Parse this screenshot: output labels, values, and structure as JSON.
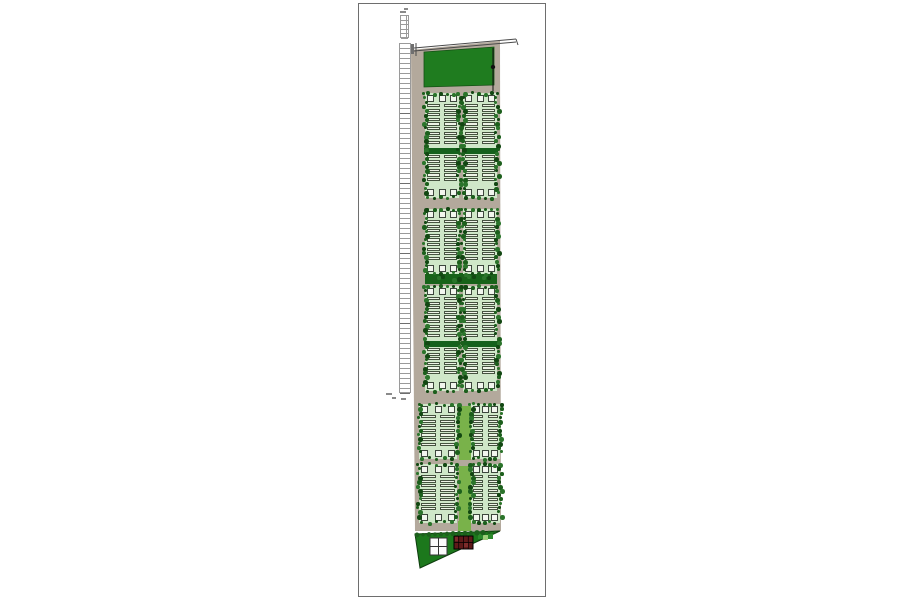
{
  "window": {
    "background": "#ffffff"
  },
  "page": {
    "x": 358,
    "y": 3,
    "width": 188,
    "height": 594,
    "background": "#ffffff",
    "border_color": "#6e6e6e"
  },
  "palette": {
    "road_tan": "#b3a99c",
    "park_green": "#1f7c1f",
    "park_edge": "#155015",
    "block_green": "#cfe7c8",
    "unit_fill": "#eef4e7",
    "unit_border": "#45523f",
    "cap_fill": "#f2f6ee",
    "cap_border": "#3c463c",
    "mid_band_green": "#15611c",
    "sep_band_green": "#176319",
    "accent_green": "#79b24a",
    "tree_palette": [
      "#124712",
      "#1c5f1c",
      "#2b742b"
    ],
    "stall_fill": "#ffffff",
    "stall_border": "#9a9a9a",
    "stall_section_border": "#6e6e6e",
    "line_dark": "#4a4a4a",
    "gate_gray": "#6f6f6f",
    "triangle_green": "#1c781c",
    "triangle_edge": "#0e3c0e",
    "building_red": "#5f1a1a",
    "building_red_light": "#7d2b2b",
    "cross_square_fill": "#fbfbfb",
    "cross_square_border": "#333333",
    "check_green_dark": "#2c8a2c",
    "check_green_light": "#9ccf7a",
    "mark_gray": "#8a8a8a",
    "flag_black": "#111111"
  },
  "site": {
    "boundary": [
      [
        52,
        46
      ],
      [
        141,
        37
      ],
      [
        142,
        527
      ],
      [
        56,
        527
      ]
    ],
    "park": {
      "points": [
        [
          65,
          48
        ],
        [
          135,
          43
        ],
        [
          135,
          81
        ],
        [
          65,
          83
        ]
      ]
    },
    "top_road": {
      "x1": 55,
      "y1": 44,
      "x2": 157,
      "y2": 35,
      "gap": 3,
      "left_tick": [
        57,
        39,
        57,
        52
      ],
      "right_tick": [
        157,
        35,
        159,
        41
      ],
      "gate_rect": [
        50,
        40,
        5,
        10
      ]
    },
    "flag_line": {
      "x": 134,
      "y1": 44,
      "y2": 87,
      "dot_y": 63,
      "dot_r": 2.2
    },
    "parking": {
      "x": 40,
      "y": 39,
      "width": 12,
      "height": 350,
      "stall_count": 70,
      "section_every": 14,
      "mini": {
        "x": 41,
        "y": 11,
        "width": 9,
        "height": 23,
        "rows": 5,
        "cols": 2
      },
      "top_marks": [
        [
          41,
          7,
          6,
          2
        ],
        [
          45,
          4,
          4,
          2
        ]
      ]
    },
    "block_rows": [
      {
        "y": 89,
        "h": 105,
        "mid_band": true,
        "wide": false
      },
      {
        "y": 205,
        "h": 65,
        "mid_band": false,
        "wide": false
      },
      {
        "y": 282,
        "h": 105,
        "mid_band": true,
        "wide": false
      },
      {
        "y": 400,
        "h": 55,
        "mid_band": false,
        "wide": true
      },
      {
        "y": 460,
        "h": 59,
        "mid_band": false,
        "wide": true
      }
    ],
    "columns": {
      "normal": {
        "left": {
          "x": 66,
          "w": 34
        },
        "right": {
          "x": 104,
          "w": 34
        }
      },
      "wide": {
        "left": {
          "x": 60,
          "w": 38
        },
        "right": {
          "x": 112,
          "w": 29
        }
      }
    },
    "units": {
      "cell_step": 4.6,
      "cell_h": 3.3,
      "cap_size": 7,
      "pad_top": 11,
      "pad_bottom": 11,
      "mid_band_pos": 0.52,
      "mid_band_h": 6
    },
    "sep_bands": [
      {
        "x": 66,
        "y": 269,
        "w": 72,
        "h": 11
      }
    ],
    "accent_strips": [
      {
        "x": 100,
        "y": 402,
        "w": 12,
        "h": 54
      },
      {
        "x": 100,
        "y": 462,
        "w": 12,
        "h": 56
      },
      {
        "x": 99,
        "y": 517,
        "w": 13,
        "h": 10
      }
    ],
    "triangle": {
      "points": [
        [
          56,
          530
        ],
        [
          141,
          527
        ],
        [
          61,
          564
        ]
      ],
      "cross_square": {
        "x": 71,
        "y": 534,
        "size": 17
      },
      "red_building": {
        "x": 95,
        "y": 532,
        "w": 19,
        "h": 13
      },
      "green_checks": {
        "x": 119,
        "y": 530,
        "cell": 5,
        "count": 3
      }
    },
    "stray_marks": [
      [
        27,
        389,
        6,
        2
      ],
      [
        33,
        393,
        4,
        2
      ],
      [
        42,
        394,
        5,
        2
      ]
    ]
  }
}
